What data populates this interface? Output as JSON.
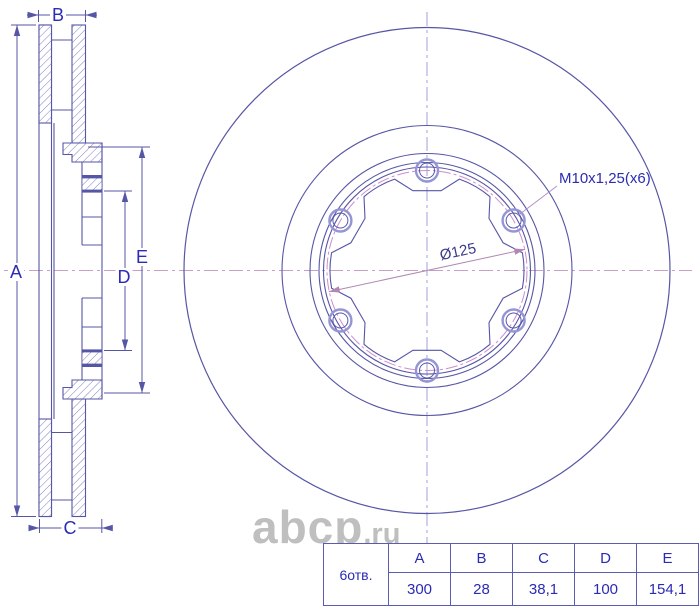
{
  "drawing": {
    "dimension_labels": {
      "A": "A",
      "B": "B",
      "C": "C",
      "D": "D",
      "E": "E"
    },
    "thread_callout": "M10x1,25(x6)",
    "bolt_circle_diameter": "Ø125",
    "watermark_main": "abcp",
    "watermark_suffix": ".ru",
    "spec_table": {
      "row_label": "6отв.",
      "headers": [
        "A",
        "B",
        "C",
        "D",
        "E"
      ],
      "values": [
        "300",
        "28",
        "38,1",
        "100",
        "154,1"
      ]
    },
    "colors": {
      "line": "#5656a6",
      "text": "#2b2bb5",
      "hatch": "#7070bb",
      "centerline_horizontal": "#c9a0c9",
      "centerline_vertical": "#a39fdc",
      "bolt_circle": "#cf8ccf",
      "watermark": "#b4b4b4"
    }
  }
}
